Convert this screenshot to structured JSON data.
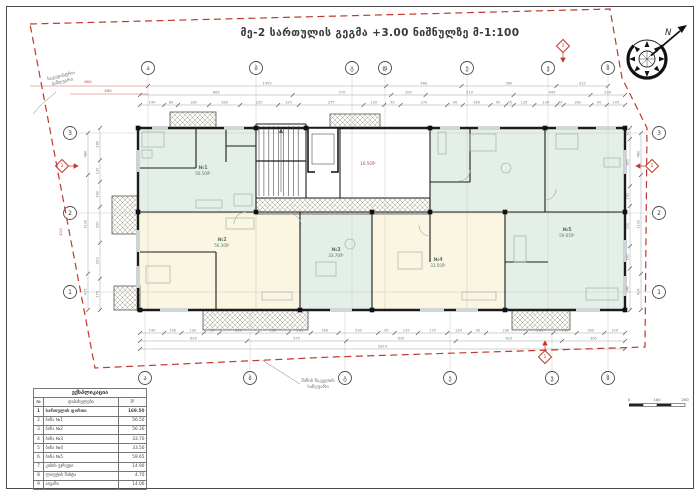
{
  "title": "მე-2 სართულის გეგმა +3.00 ნიშნულზე მ-1:100",
  "annotations": {
    "boundary_top_left": [
      "საკადასტრო",
      "საზღვარი"
    ],
    "boundary_bottom": [
      "მიწის ნაკვეთის",
      "საზღვარი"
    ],
    "north_label": "N"
  },
  "axes": {
    "top": [
      {
        "label": "ა",
        "x": 148
      },
      {
        "label": "ბ",
        "x": 256
      },
      {
        "label": "გ",
        "x": 352
      },
      {
        "label": "დ",
        "x": 385
      },
      {
        "label": "ე",
        "x": 467
      },
      {
        "label": "ვ",
        "x": 548
      },
      {
        "label": "ზ",
        "x": 608
      }
    ],
    "bottom": [
      {
        "label": "ა",
        "x": 145
      },
      {
        "label": "ბ",
        "x": 250
      },
      {
        "label": "გ",
        "x": 345
      },
      {
        "label": "ე",
        "x": 450
      },
      {
        "label": "ვ",
        "x": 552
      },
      {
        "label": "ზ",
        "x": 608
      }
    ],
    "left": [
      {
        "label": "3",
        "y": 133
      },
      {
        "label": "2",
        "y": 213
      },
      {
        "label": "1",
        "y": 292
      }
    ],
    "right": [
      {
        "label": "3",
        "y": 133
      },
      {
        "label": "2",
        "y": 213
      },
      {
        "label": "1",
        "y": 292
      }
    ]
  },
  "sections": [
    {
      "label": "1",
      "x": 563,
      "y": 46,
      "dir": "down"
    },
    {
      "label": "1",
      "x": 545,
      "y": 357,
      "dir": "up"
    },
    {
      "label": "2",
      "x": 62,
      "y": 166,
      "dir": "right"
    },
    {
      "label": "2",
      "x": 652,
      "y": 166,
      "dir": "left"
    }
  ],
  "rooms": [
    {
      "no": "№1",
      "area": "56.50მ²",
      "x": 203,
      "y": 172
    },
    {
      "no": "№2",
      "area": "56.30მ²",
      "x": 222,
      "y": 244
    },
    {
      "no": "№3",
      "area": "33.70მ²",
      "x": 336,
      "y": 254
    },
    {
      "no": "№4",
      "area": "33.50მ²",
      "x": 438,
      "y": 264
    },
    {
      "no": "№5",
      "area": "59.65მ²",
      "x": 567,
      "y": 234
    },
    {
      "no": "",
      "area": "16.50მ²",
      "x": 368,
      "y": 162,
      "red": true
    }
  ],
  "dims": {
    "h_chains": [
      {
        "y": 86,
        "x0": 148,
        "x1": 608,
        "values": [
          1455,
          460,
          580,
          315
        ]
      },
      {
        "y": 95,
        "x0": 140,
        "x1": 625,
        "values": [
          885,
          570,
          200,
          510,
          445,
          200
        ]
      },
      {
        "y": 105,
        "x0": 140,
        "x1": 625,
        "values": [
          140,
          80,
          180,
          180,
          220,
          120,
          375,
          120,
          95,
          270,
          90,
          160,
          90,
          45,
          120,
          130,
          40,
          160,
          90,
          105
        ]
      },
      {
        "y": 333,
        "x0": 140,
        "x1": 625,
        "values": [
          140,
          100,
          130,
          90,
          220,
          180,
          130,
          160,
          230,
          95,
          135,
          170,
          130,
          95,
          230,
          160,
          135,
          160,
          120
        ]
      },
      {
        "y": 341,
        "x0": 140,
        "x1": 625,
        "values": [
          620,
          575,
          635,
          615,
          365
        ]
      },
      {
        "y": 349,
        "x0": 140,
        "x1": 625,
        "values": [
          2810
        ]
      }
    ],
    "v_chains": [
      {
        "x": 88,
        "y0": 133,
        "y1": 310,
        "values": [
          480,
          1130,
          415
        ]
      },
      {
        "x": 100,
        "y0": 128,
        "y1": 310,
        "values": [
          180,
          120,
          140,
          200,
          200,
          175
        ]
      },
      {
        "x": 641,
        "y0": 133,
        "y1": 310,
        "values": [
          480,
          1130,
          415
        ]
      },
      {
        "x": 630,
        "y0": 128,
        "y1": 310,
        "values": [
          90,
          385,
          160,
          330,
          180,
          340
        ]
      }
    ],
    "red": [
      {
        "text": "600",
        "x": 88,
        "y": 83,
        "rot": false
      },
      {
        "text": "490",
        "x": 108,
        "y": 92,
        "rot": false
      },
      {
        "text": "410",
        "x": 62,
        "y": 232,
        "rot": true
      }
    ]
  },
  "table": {
    "title": "ექსპლიკაცია",
    "headers": [
      "№",
      "დასახელება",
      "მ²"
    ],
    "rows": [
      [
        "1",
        "სართულის ფართი",
        "169.50"
      ],
      [
        "2",
        "ბინა №1",
        "56.50"
      ],
      [
        "3",
        "ბინა №2",
        "56.30"
      ],
      [
        "4",
        "ბინა №3",
        "33.70"
      ],
      [
        "5",
        "ბინა №4",
        "33.50"
      ],
      [
        "6",
        "ბინა №5",
        "59.65"
      ],
      [
        "7",
        "კიბის უჯრედი",
        "14.90"
      ],
      [
        "8",
        "ლიფტის შახტა",
        "4.70"
      ],
      [
        "9",
        "აივანი",
        "14.06"
      ]
    ]
  },
  "scale_bar": {
    "labels": [
      "0",
      "100",
      "200"
    ]
  },
  "colors": {
    "boundary": "#c0392b",
    "mint": "#e3efe7",
    "cream": "#faf6e2",
    "wall": "#1c1c1c"
  }
}
